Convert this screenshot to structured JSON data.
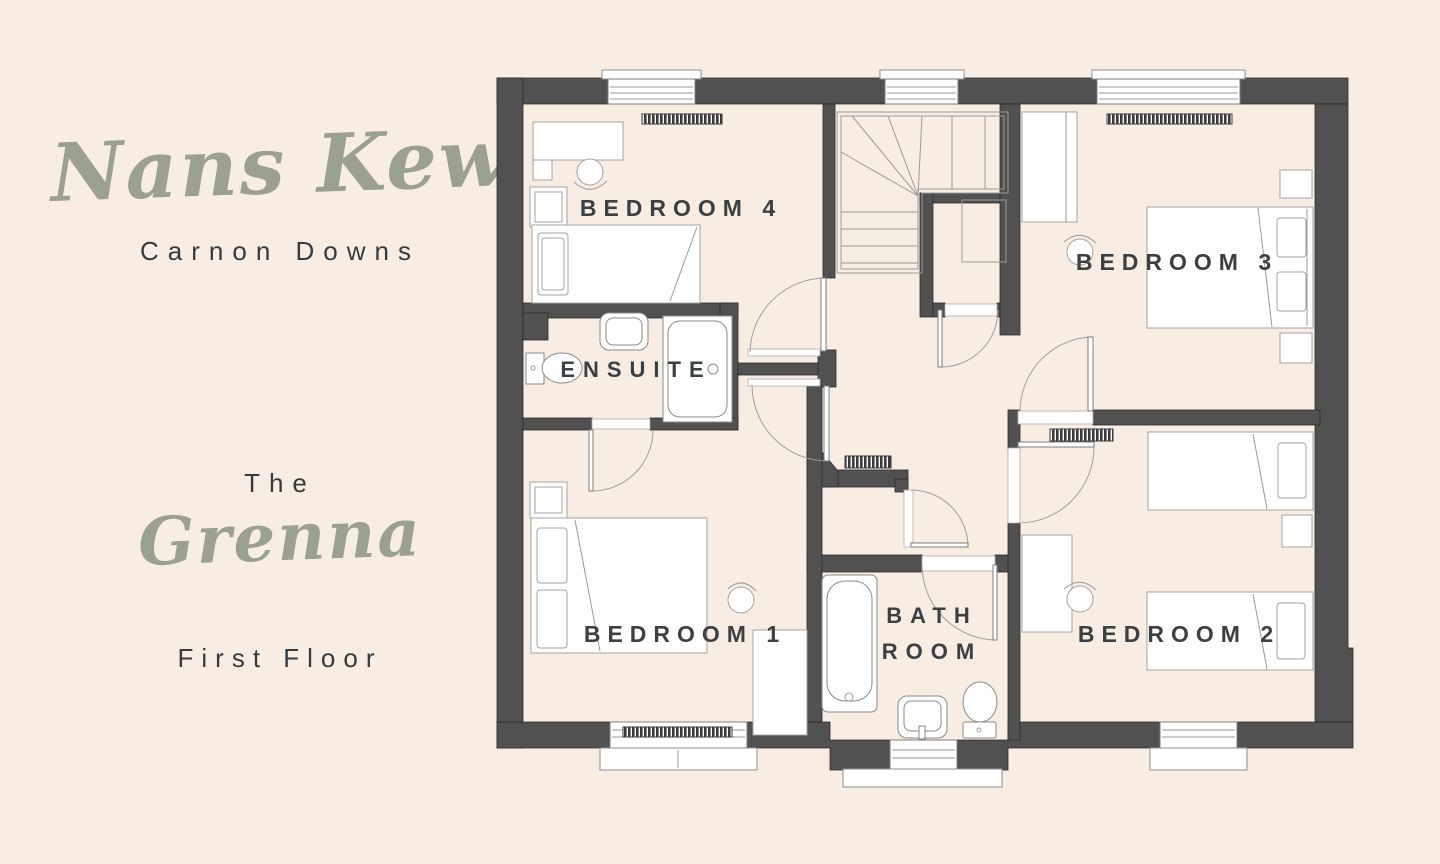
{
  "brand": {
    "name": "Nans Kew",
    "location": "Carnon Downs"
  },
  "plot": {
    "prefix": "The",
    "name": "Grenna",
    "floor": "First Floor"
  },
  "floorplan": {
    "labels": {
      "bedroom4": "BEDROOM 4",
      "bedroom3": "BEDROOM 3",
      "ensuite": "ENSUITE",
      "bedroom1": "BEDROOM 1",
      "bath_line1": "BATH",
      "bath_line2": "ROOM",
      "bedroom2": "BEDROOM 2"
    }
  },
  "colors": {
    "background": "#f8ede3",
    "wall": "#515151",
    "accent": "#9aa092",
    "text": "#363b3e",
    "plan_line": "#9a9a9a"
  }
}
